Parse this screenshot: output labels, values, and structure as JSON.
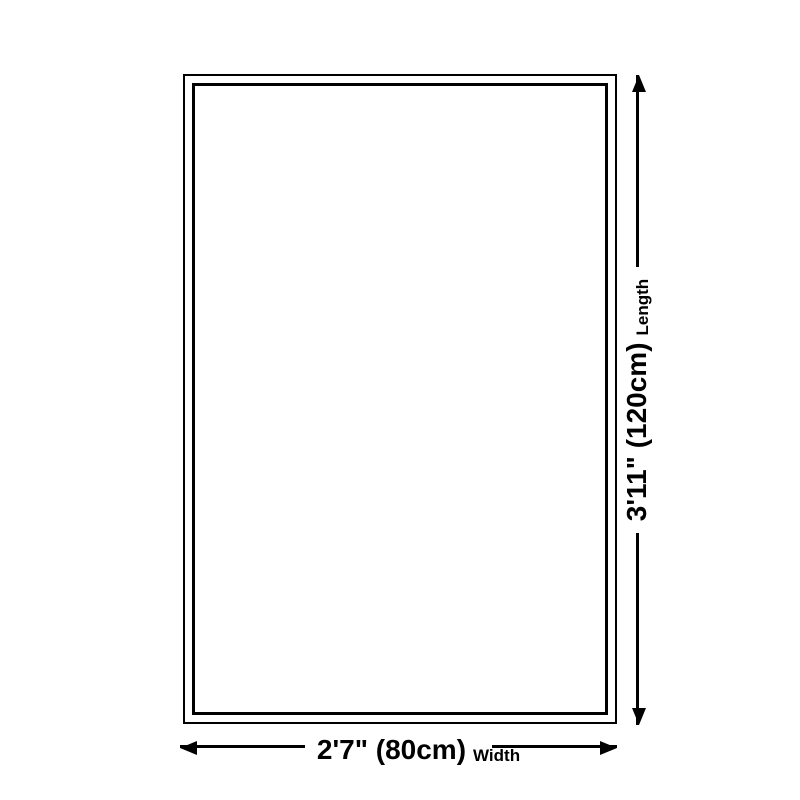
{
  "diagram": {
    "background": "#ffffff",
    "line_color": "#000000"
  },
  "dimensions": {
    "length": {
      "value": "3'11\" (120cm)",
      "label": "Length"
    },
    "width": {
      "value": "2'7\" (80cm)",
      "label": "Width"
    }
  }
}
